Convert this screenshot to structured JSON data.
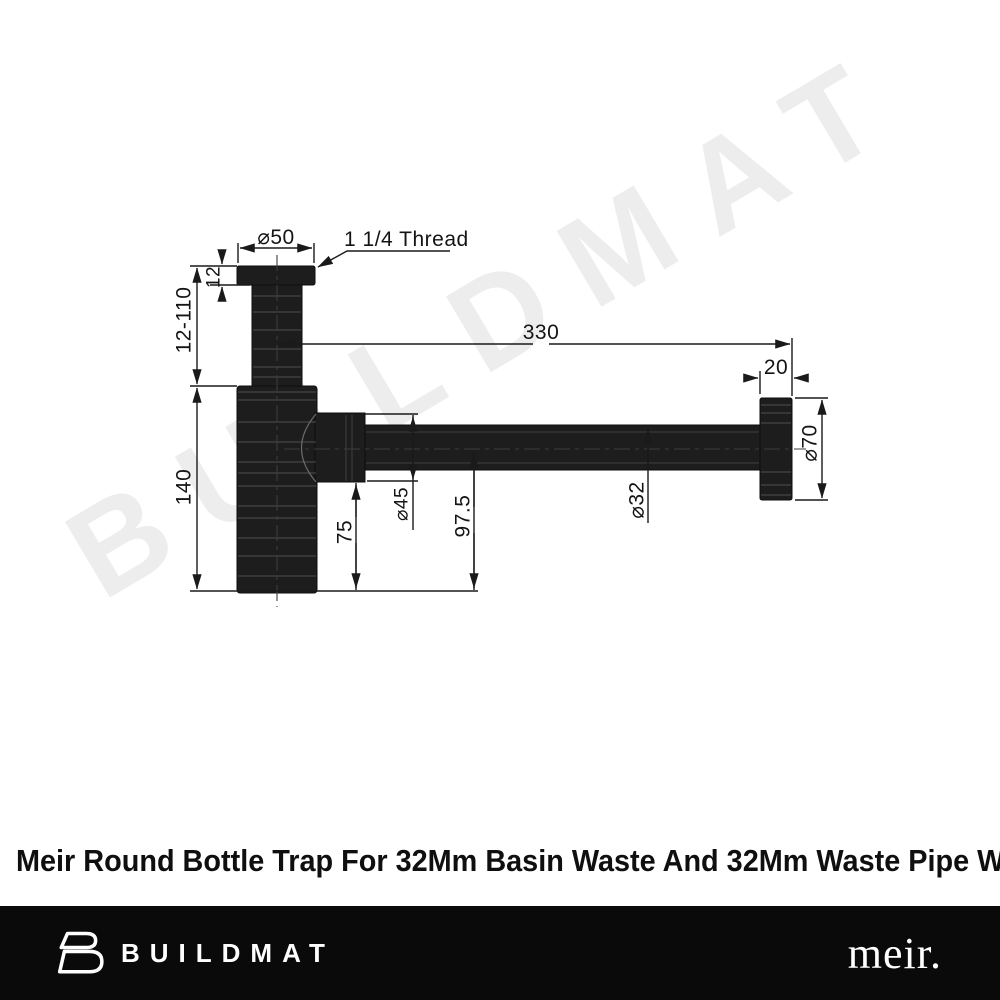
{
  "watermark": {
    "text": "BUILDMAT",
    "color": "#ededed"
  },
  "drawing": {
    "part_color": "#1d1d1d",
    "line_color": "#1a1a1a",
    "labels": {
      "flange_diameter": "⌀50",
      "thread": "1 1/4 Thread",
      "flange_height": "12",
      "inlet_height_range": "12-110",
      "body_height": "140",
      "reach": "330",
      "wall_flange_depth": "20",
      "wall_flange_diameter": "⌀70",
      "outlet_nut_diameter": "⌀45",
      "outlet_drop": "75",
      "centre_height": "97.5",
      "pipe_diameter": "⌀32"
    }
  },
  "title": "Meir Round Bottle Trap For 32Mm Basin Waste And 32Mm Waste Pipe With 40Mm",
  "footer": {
    "brand": "BUILDMAT",
    "brand_logo_icon": "buildmat-b-icon",
    "partner_brand": "meir."
  }
}
